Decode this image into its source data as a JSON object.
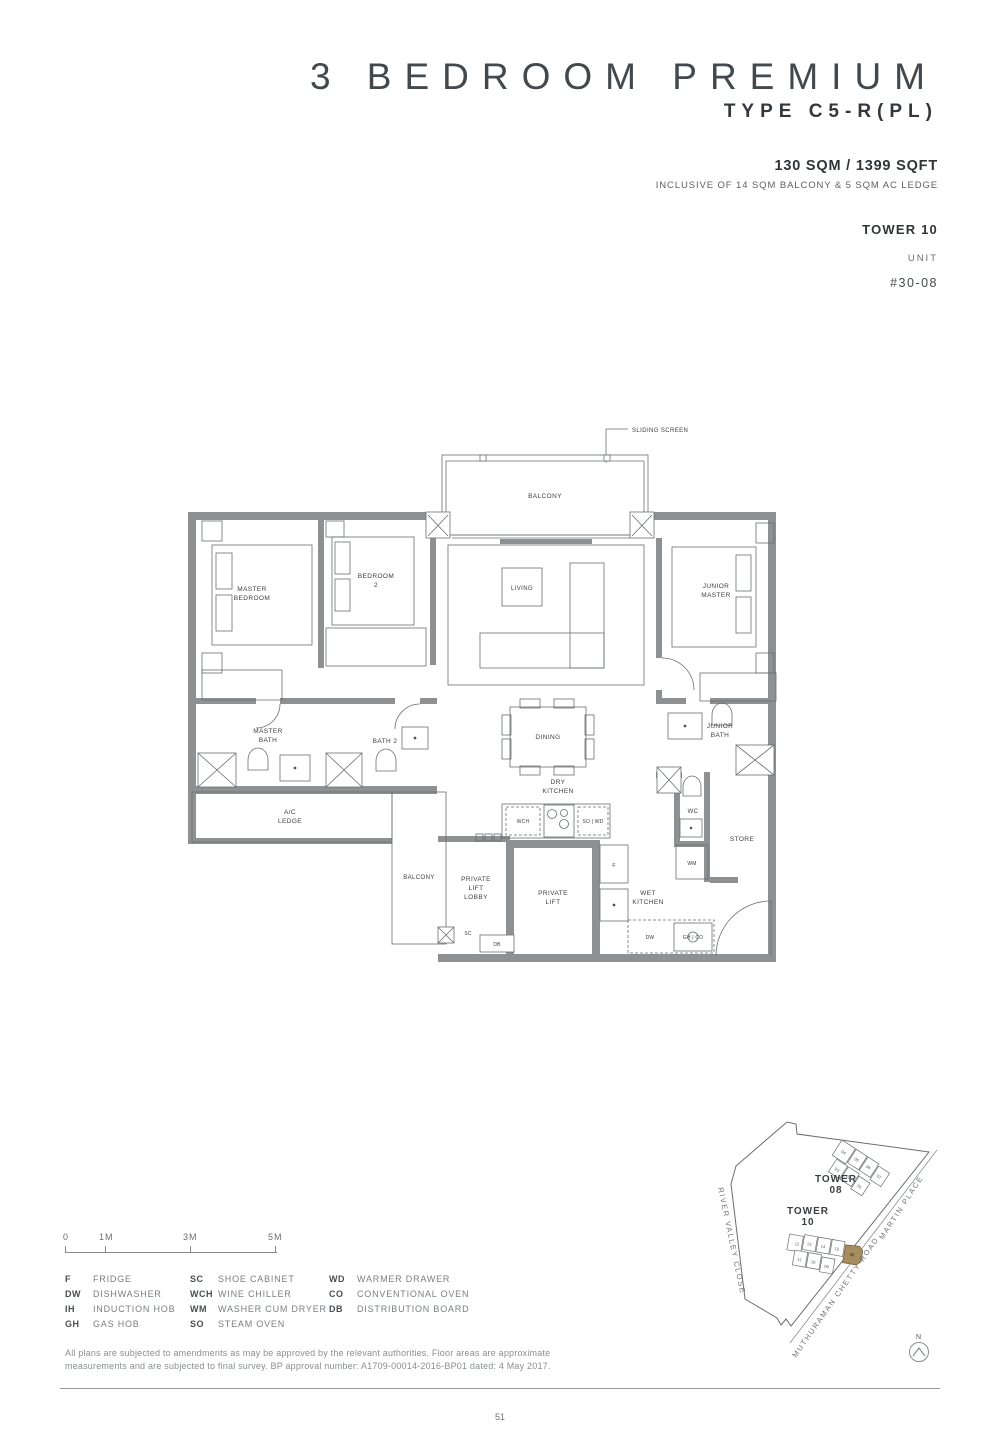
{
  "header": {
    "title": "3 BEDROOM PREMIUM",
    "subtitle": "TYPE C5-R(PL)",
    "area": "130 SQM / 1399 SQFT",
    "area_note": "INCLUSIVE OF 14 SQM BALCONY & 5 SQM AC LEDGE",
    "tower": "TOWER 10",
    "unit_label": "UNIT",
    "unit_number": "#30-08"
  },
  "plan": {
    "callout": "SLIDING SCREEN",
    "rooms": {
      "balcony": "BALCONY",
      "master_bedroom": [
        "MASTER",
        "BEDROOM"
      ],
      "bedroom2": [
        "BEDROOM",
        "2"
      ],
      "living": "LIVING",
      "junior_master": [
        "JUNIOR",
        "MASTER"
      ],
      "master_bath": [
        "MASTER",
        "BATH"
      ],
      "bath2": "BATH 2",
      "ac_ledge": [
        "A/C",
        "LEDGE"
      ],
      "balcony2": "BALCONY",
      "dining": "DINING",
      "dry_kitchen": [
        "DRY",
        "KITCHEN"
      ],
      "junior_bath": [
        "JUNIOR",
        "BATH"
      ],
      "wc": "WC",
      "store": "STORE",
      "private_lift_lobby": [
        "PRIVATE",
        "LIFT",
        "LOBBY"
      ],
      "private_lift": [
        "PRIVATE",
        "LIFT"
      ],
      "wet_kitchen": [
        "WET",
        "KITCHEN"
      ]
    },
    "fixtures": {
      "wch": "WCH",
      "so_wd": "SO | WD",
      "f": "F",
      "wm": "WM",
      "dw": "DW",
      "gh_co": "GH | CO",
      "sc": "SC",
      "db": "DB"
    }
  },
  "scale_bar": {
    "ticks": [
      "0",
      "1M",
      "3M",
      "5M"
    ]
  },
  "legend": {
    "columns": [
      {
        "items": [
          {
            "abbr": "F",
            "label": "FRIDGE"
          },
          {
            "abbr": "DW",
            "label": "DISHWASHER"
          },
          {
            "abbr": "IH",
            "label": "INDUCTION HOB"
          },
          {
            "abbr": "GH",
            "label": "GAS HOB"
          }
        ]
      },
      {
        "items": [
          {
            "abbr": "SC",
            "label": "SHOE CABINET"
          },
          {
            "abbr": "WCH",
            "label": "WINE CHILLER"
          },
          {
            "abbr": "WM",
            "label": "WASHER CUM DRYER"
          },
          {
            "abbr": "SO",
            "label": "STEAM OVEN"
          }
        ]
      },
      {
        "items": [
          {
            "abbr": "WD",
            "label": "WARMER DRAWER"
          },
          {
            "abbr": "CO",
            "label": "CONVENTIONAL OVEN"
          },
          {
            "abbr": "DB",
            "label": "DISTRIBUTION BOARD"
          }
        ]
      }
    ]
  },
  "map": {
    "tower08": [
      "TOWER",
      "08"
    ],
    "tower10": [
      "TOWER",
      "10"
    ],
    "tower08_units": [
      "04",
      "05",
      "06",
      "07",
      "03",
      "02",
      "01"
    ],
    "tower10_units": [
      "12",
      "13",
      "14",
      "15",
      "11",
      "10",
      "09"
    ],
    "highlight_unit": "08",
    "highlight_color": "#a68c5f",
    "roads": {
      "left": "RIVER VALLEY CLOSE",
      "bottom": "MUTHURAMAN CHETTY ROAD",
      "right": "MARTIN PLACE"
    },
    "north": "N"
  },
  "footer": {
    "disclaimer_lines": [
      "All plans are subjected to amendments as may be approved by the relevant authorities. Floor areas are approximate",
      "measurements and are subjected to final survey. BP approval number: A1709-00014-2016-BP01 dated: 4 May 2017."
    ],
    "page_number": "51"
  }
}
